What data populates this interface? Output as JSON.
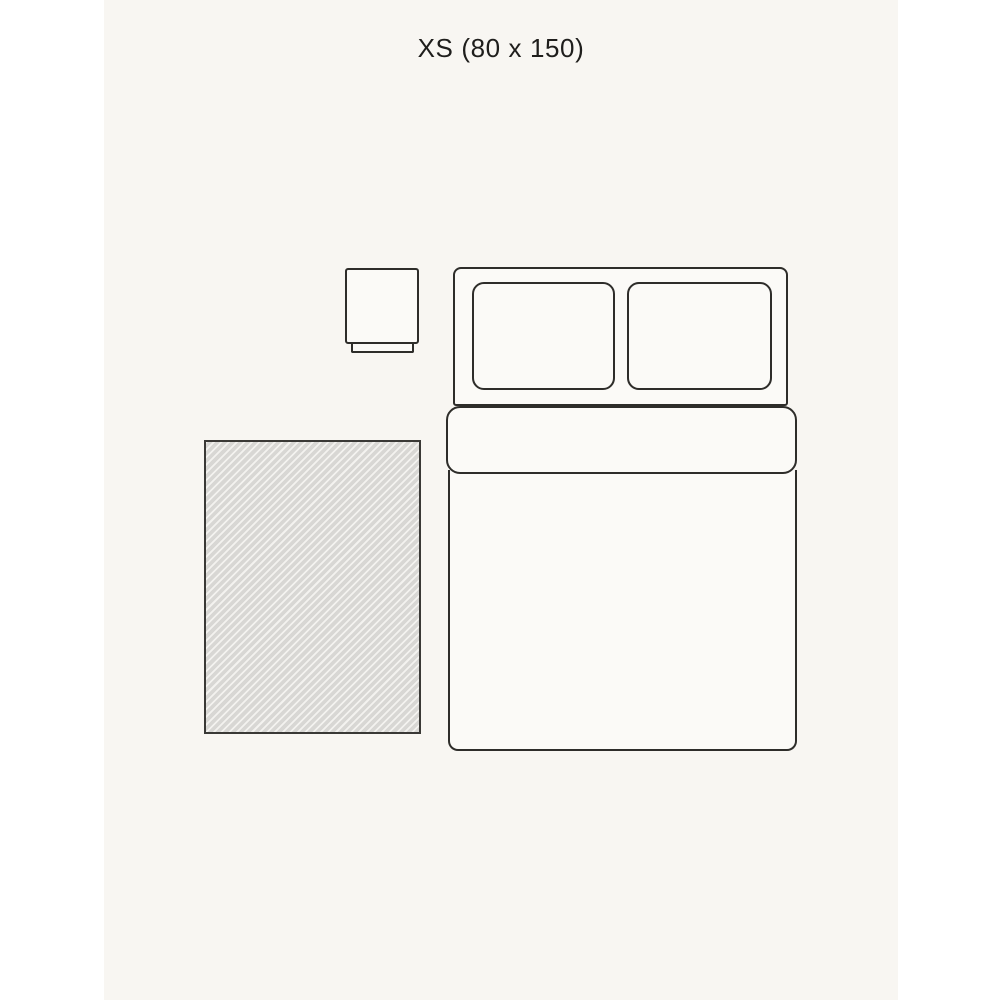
{
  "page": {
    "background_color": "#ffffff",
    "canvas_background_color": "#f8f6f2",
    "line_color": "#2e2d2a",
    "shape_fill_color": "#fbfaf7"
  },
  "header": {
    "size_label": "XS (80 x 150)",
    "size_code": "XS",
    "rug_width_cm": 80,
    "rug_length_cm": 150
  },
  "diagram": {
    "description": "Top-down bedroom size guide showing an XS rug beside a double bed and a nightstand",
    "elements": [
      "nightstand",
      "double-bed",
      "pillow-left",
      "pillow-right",
      "duvet-fold",
      "duvet-body",
      "rug"
    ],
    "rug": {
      "pattern": "diagonal-hatch",
      "hatch_dark_color": "#d8d7d4",
      "hatch_light_color": "#f3f2ef",
      "border_color": "#3a3936"
    }
  }
}
